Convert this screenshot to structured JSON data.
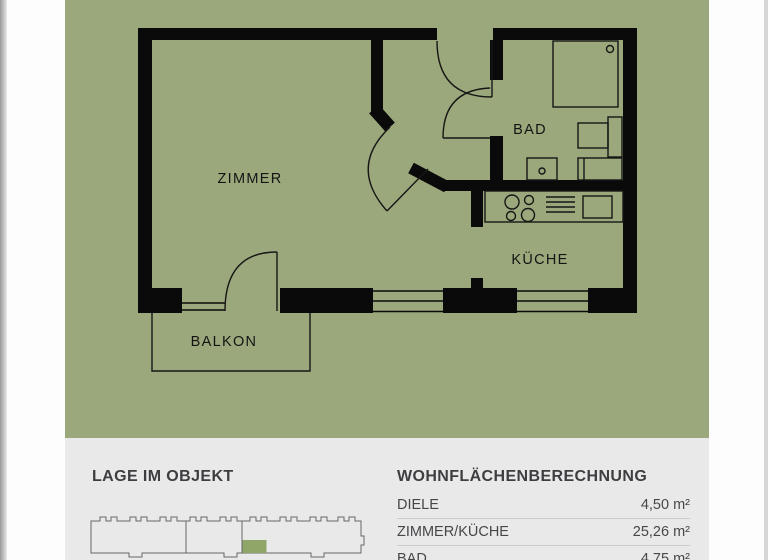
{
  "plan": {
    "labels": {
      "zimmer": "ZIMMER",
      "bad": "BAD",
      "kueche": "KÜCHE",
      "balkon": "BALKON"
    },
    "colors": {
      "background": "#9ba87b",
      "wall": "#0a0a0a",
      "line": "#161616"
    }
  },
  "info": {
    "location": {
      "title": "LAGE IM OBJEKT",
      "highlight_color": "#8fa668"
    },
    "area_table": {
      "title": "WOHNFLÄCHENBERECHNUNG",
      "rows": [
        {
          "label": "DIELE",
          "value": "4,50 m²"
        },
        {
          "label": "ZIMMER/KÜCHE",
          "value": "25,26 m²"
        },
        {
          "label": "BAD",
          "value": "4,75 m²"
        }
      ]
    }
  }
}
